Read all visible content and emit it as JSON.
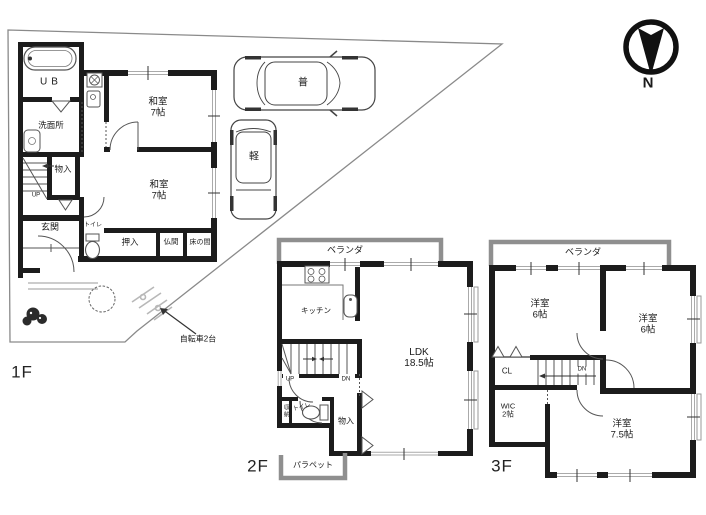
{
  "site": {
    "bicycle_note": "自転車2台",
    "car_full": "普",
    "car_kei": "軽",
    "compass_n": "N"
  },
  "floor1": {
    "floor_label": "1F",
    "unit_bath": "UB",
    "washroom": "洗面所",
    "storage": "物入",
    "tatami_room_n": {
      "name": "和室",
      "size": "7帖"
    },
    "tatami_room_s": {
      "name": "和室",
      "size": "7帖"
    },
    "entrance": "玄関",
    "toilet": "トイレ",
    "closet": "押入",
    "altar_room": "仏間",
    "alcove": "床の間",
    "stairs_up": "UP"
  },
  "floor2": {
    "floor_label": "2F",
    "veranda": "ベランダ",
    "kitchen": "キッチン",
    "ldk": {
      "name": "LDK",
      "size": "18.5帖"
    },
    "stairs_up": "UP",
    "stairs_down": "DN",
    "storage_small": "収納",
    "toilet": "トイレ",
    "storage": "物入",
    "parapet": "パラペット"
  },
  "floor3": {
    "floor_label": "3F",
    "veranda": "ベランダ",
    "western_room_1": {
      "name": "洋室",
      "size": "6帖"
    },
    "western_room_2": {
      "name": "洋室",
      "size": "6帖"
    },
    "closet": "CL",
    "stairs_down": "DN",
    "wic": {
      "name": "WIC",
      "size": "2帖"
    },
    "western_room_3": {
      "name": "洋室",
      "size": "7.5帖"
    }
  },
  "colors": {
    "wall": "#1c1c1c",
    "veranda": "#8f8f8f",
    "line": "#555555",
    "window": "#aaaaaa"
  }
}
